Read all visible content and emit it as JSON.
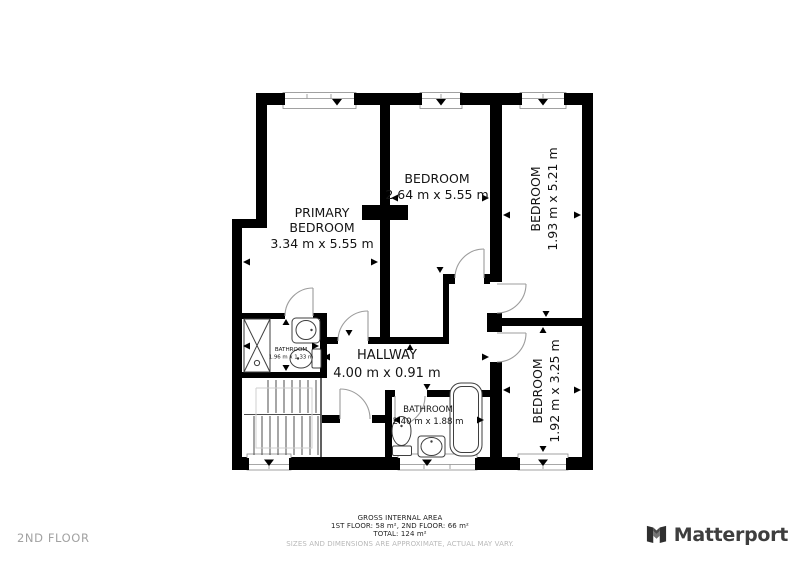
{
  "floor_label": "2ND FLOOR",
  "brand": {
    "name": "Matterport"
  },
  "footer": {
    "title": "GROSS INTERNAL AREA",
    "floors": "1ST FLOOR: 58 m², 2ND FLOOR: 66 m²",
    "total": "TOTAL: 124 m²",
    "disclaimer": "SIZES AND DIMENSIONS ARE APPROXIMATE, ACTUAL MAY VARY."
  },
  "rooms": {
    "primary": {
      "label_line1": "PRIMARY",
      "label_line2": "BEDROOM",
      "dims": "3.34 m x 5.55 m"
    },
    "bedroom_mid": {
      "label": "BEDROOM",
      "dims": "2.64 m x 5.55 m"
    },
    "bedroom_ne": {
      "label": "BEDROOM",
      "dims": "1.93 m x 5.21 m"
    },
    "bedroom_se": {
      "label": "BEDROOM",
      "dims": "1.92 m x 3.25 m"
    },
    "hallway": {
      "label": "HALLWAY",
      "dims": "4.00 m x 0.91 m"
    },
    "bathroom_ensuite": {
      "label": "BATHROOM",
      "dims": "1.96 m x 1.33 m"
    },
    "bathroom_main": {
      "label": "BATHROOM",
      "dims": "2.40 m x 1.88 m"
    }
  },
  "colors": {
    "wall": "#000000",
    "door_arc": "#9c9c9c",
    "fixture_stroke": "#3f3f3f",
    "label_text": "#141414",
    "footer_text": "#1f1f1f",
    "muted_text": "#a2a2a2",
    "brand_text": "#3e3e3e"
  }
}
